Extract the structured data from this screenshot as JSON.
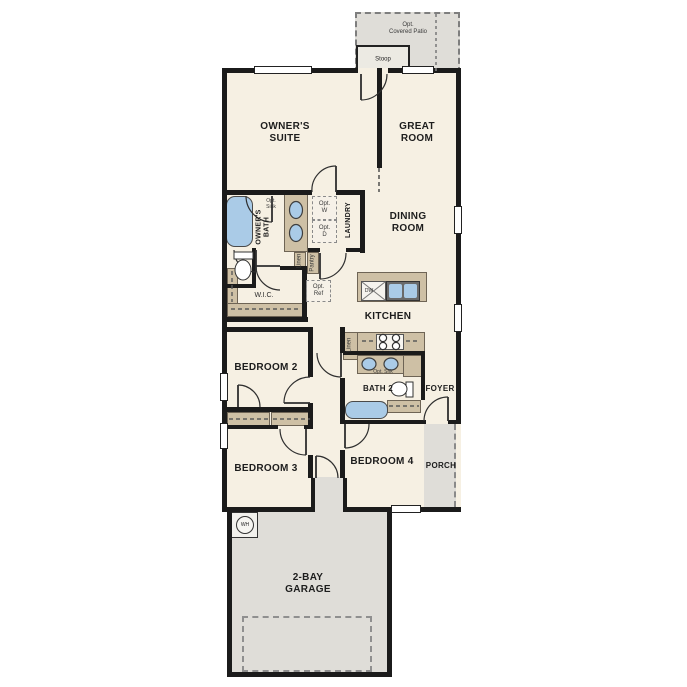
{
  "colors": {
    "floor": "#f6f0e3",
    "wall": "#1b1b1b",
    "counter": "#cec0a5",
    "fixture": "#aacbe7",
    "exterior": "#dfddd8"
  },
  "labels": {
    "patio": "Opt.\nCovered Patio",
    "stoop": "Stoop",
    "owners_suite": "OWNER'S\nSUITE",
    "great_room": "GREAT\nROOM",
    "owners_bath": "OWNER'S\nBATH",
    "opt_sink": "Opt.\nSink",
    "opt_w": "Opt.\nW",
    "opt_d": "Opt.\nD",
    "laundry": "LAUNDRY",
    "linen_hall": "Linen",
    "pantry": "Pantry",
    "wic": "W.I.C.",
    "opt_ref": "Opt.\nRef",
    "dining_room": "DINING\nROOM",
    "dw": "DW",
    "kitchen": "KITCHEN",
    "linen_kitchen": "Linen",
    "opt_snk": "Opt. Snk",
    "bath2": "BATH 2",
    "foyer": "FOYER",
    "bedroom2": "BEDROOM 2",
    "bedroom3": "BEDROOM 3",
    "bedroom4": "BEDROOM 4",
    "porch": "PORCH",
    "wh": "WH",
    "garage": "2-BAY\nGARAGE"
  }
}
